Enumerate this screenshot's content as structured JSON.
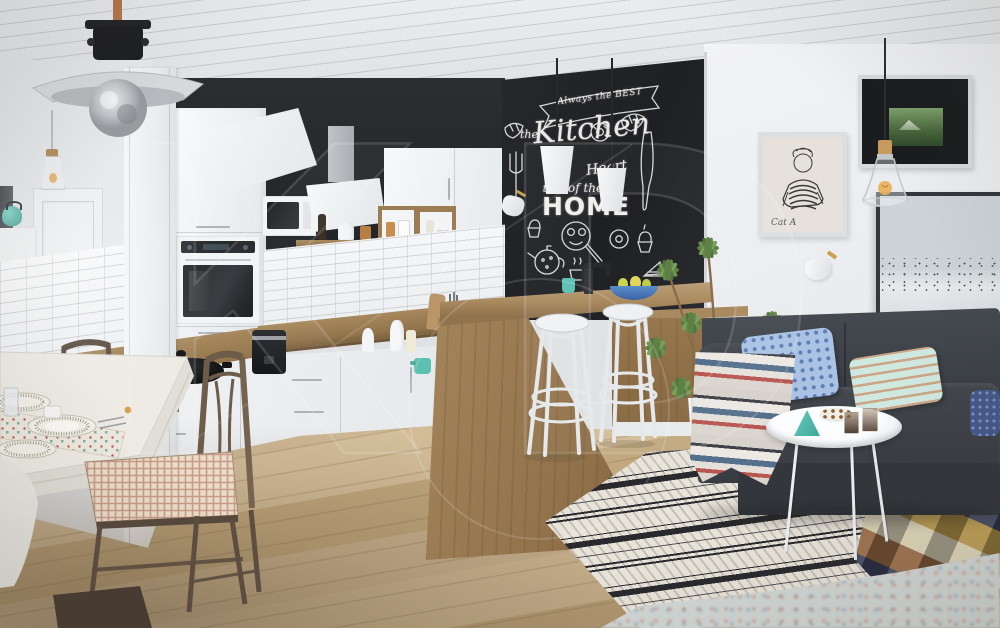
{
  "scene": {
    "description": "Scandinavian open-plan interior: white glossy kitchen with chalkboard accent wall, wooden bar with bentwood stools, white dining set with dark chairs, charcoal sofa and monochrome rug",
    "watermark_text": "KD",
    "colors": {
      "ceiling": "#e7e9eb",
      "wall_white": "#eff0f2",
      "chalkboard": "#232528",
      "accent_wall": "#26292c",
      "cabinet_white": "#f4f6f7",
      "counter_wood": "#9c7c52",
      "island_wood": "#a5865c",
      "floor_wood": "#c8b18c",
      "sofa_charcoal": "#3b4046",
      "rug_base": "#e9e4da",
      "rug_pattern": "#2a2a2e",
      "chair_wood": "#6b5a4a",
      "plant_green": "#6d9350",
      "teal_accent": "#56c2b5",
      "pillow_blue": "#a9c2e4",
      "pillow_aqua": "#cfe8e0",
      "plaid_mustard": "#b3903d",
      "plaid_navy": "#30354f"
    }
  },
  "chalkboard": {
    "banner": "Always the BEST",
    "the": "the",
    "kitchen": "Kitchen",
    "is_the": "is the",
    "heart": "Heart",
    "of_the": "of the",
    "home": "HOME"
  },
  "art": {
    "sketch_signature": "Cat A"
  }
}
